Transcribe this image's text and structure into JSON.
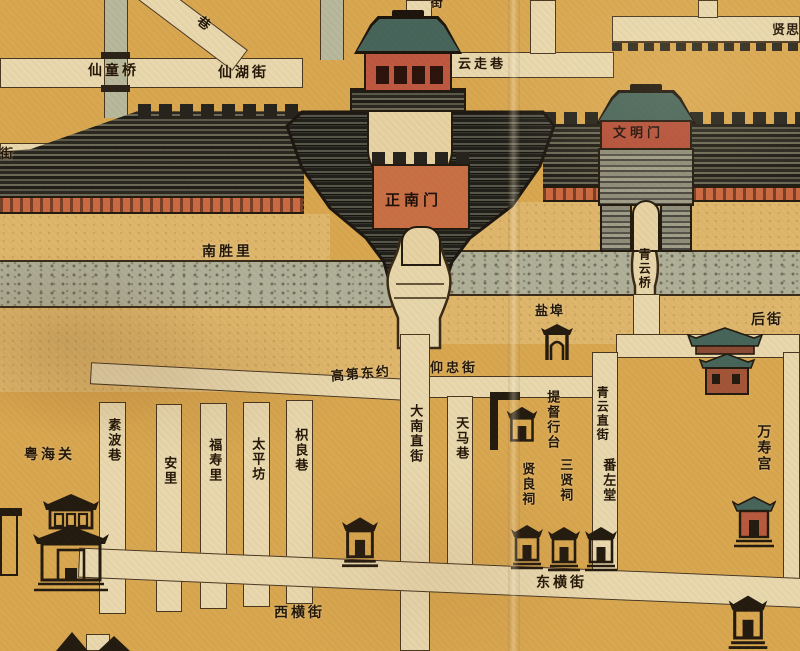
{
  "palette": {
    "paper": "#d9a750",
    "street": "#e9d8ae",
    "canal": "#b7b89c",
    "bank": "#dfb76c",
    "moat": "#b0b099",
    "wall_dark": "#26241d",
    "wall_base_band": "#cb6a42",
    "gate_red": "#bf5840",
    "gate_orange": "#c96f45",
    "roof_teal": "#47655b",
    "ink": "#241708"
  },
  "gates": {
    "zhengnanmen": "正南门",
    "wenmingmen": "文明门"
  },
  "bridges": {
    "xiantongqiao": "仙童桥",
    "qingyunqiao": "青云桥"
  },
  "streets": {
    "xianhujie": "仙湖街",
    "yunzouxiang": "云走巷",
    "nanshengli": "南胜里",
    "houjie": "后街",
    "yangzhongjie": "仰忠街",
    "gaodidongyue": "高第东约",
    "dananzhijie": "大南直街",
    "tianmaxiang": "天马巷",
    "subuoxiang": "素波巷",
    "anli": "安里",
    "fushouli": "福寿里",
    "taipingfang": "太平坊",
    "zhiliangxiang": "枳良巷",
    "qingyunzhijie": "青云直街",
    "xihengjie": "西横街",
    "donghengjie": "东横街",
    "partial_lane_top": "巷",
    "partial_street_left": "街",
    "partial_street_top": "街",
    "xiansi_partial": "贤思"
  },
  "places": {
    "yuehaiguan": "粤海关",
    "yanbu": "盐埠",
    "tiduxingtai": "提督行台",
    "xianliangci": "贤良祠",
    "sanxianci": "三贤祠",
    "fanzuotang": "番左堂",
    "wanshougong": "万寿宫"
  }
}
